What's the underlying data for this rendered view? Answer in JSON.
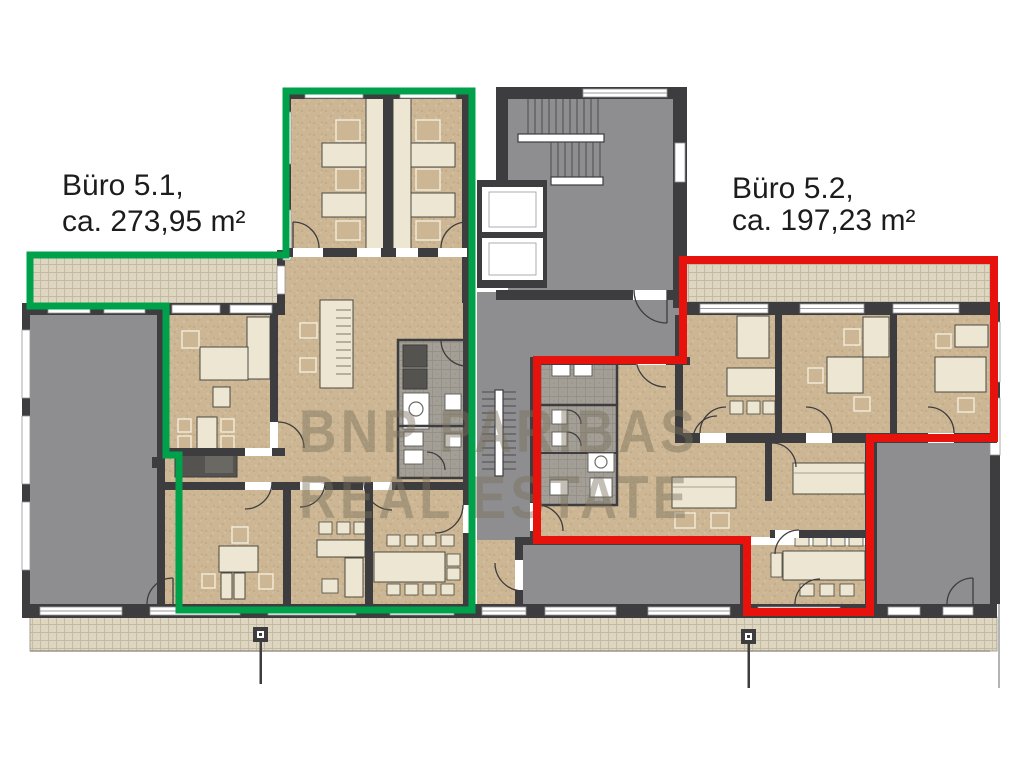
{
  "document": {
    "type": "floor-plan",
    "language": "de"
  },
  "units": {
    "buero_5_1": {
      "name": "Büro 5.1",
      "area_sqm": "273,95",
      "label_line1": "Büro 5.1,",
      "label_line2": "ca. 273,95 m²",
      "outline_color": "#00a14b"
    },
    "buero_5_2": {
      "name": "Büro 5.2",
      "area_sqm": "197,23",
      "label_line1": "Büro 5.2,",
      "label_line2": "ca. 197,23 m²",
      "outline_color": "#e8120d"
    }
  },
  "watermark": {
    "line1": "BNP PARIBAS",
    "line2": "REAL ESTATE"
  },
  "colors": {
    "background": "#ffffff",
    "green_outline": "#00a14b",
    "red_outline": "#e8120d",
    "wall": "#3d3d3f",
    "floor_tan": "#cdb693",
    "floor_gray": "#8e8e91",
    "core_tile": "#a39f96",
    "furniture": "#ede6d2",
    "terrace_base": "#ded6c0",
    "terrace_line": "#c3baa2",
    "watermark": "rgba(122,112,94,0.45)",
    "label_text": "#1c1c1c"
  }
}
